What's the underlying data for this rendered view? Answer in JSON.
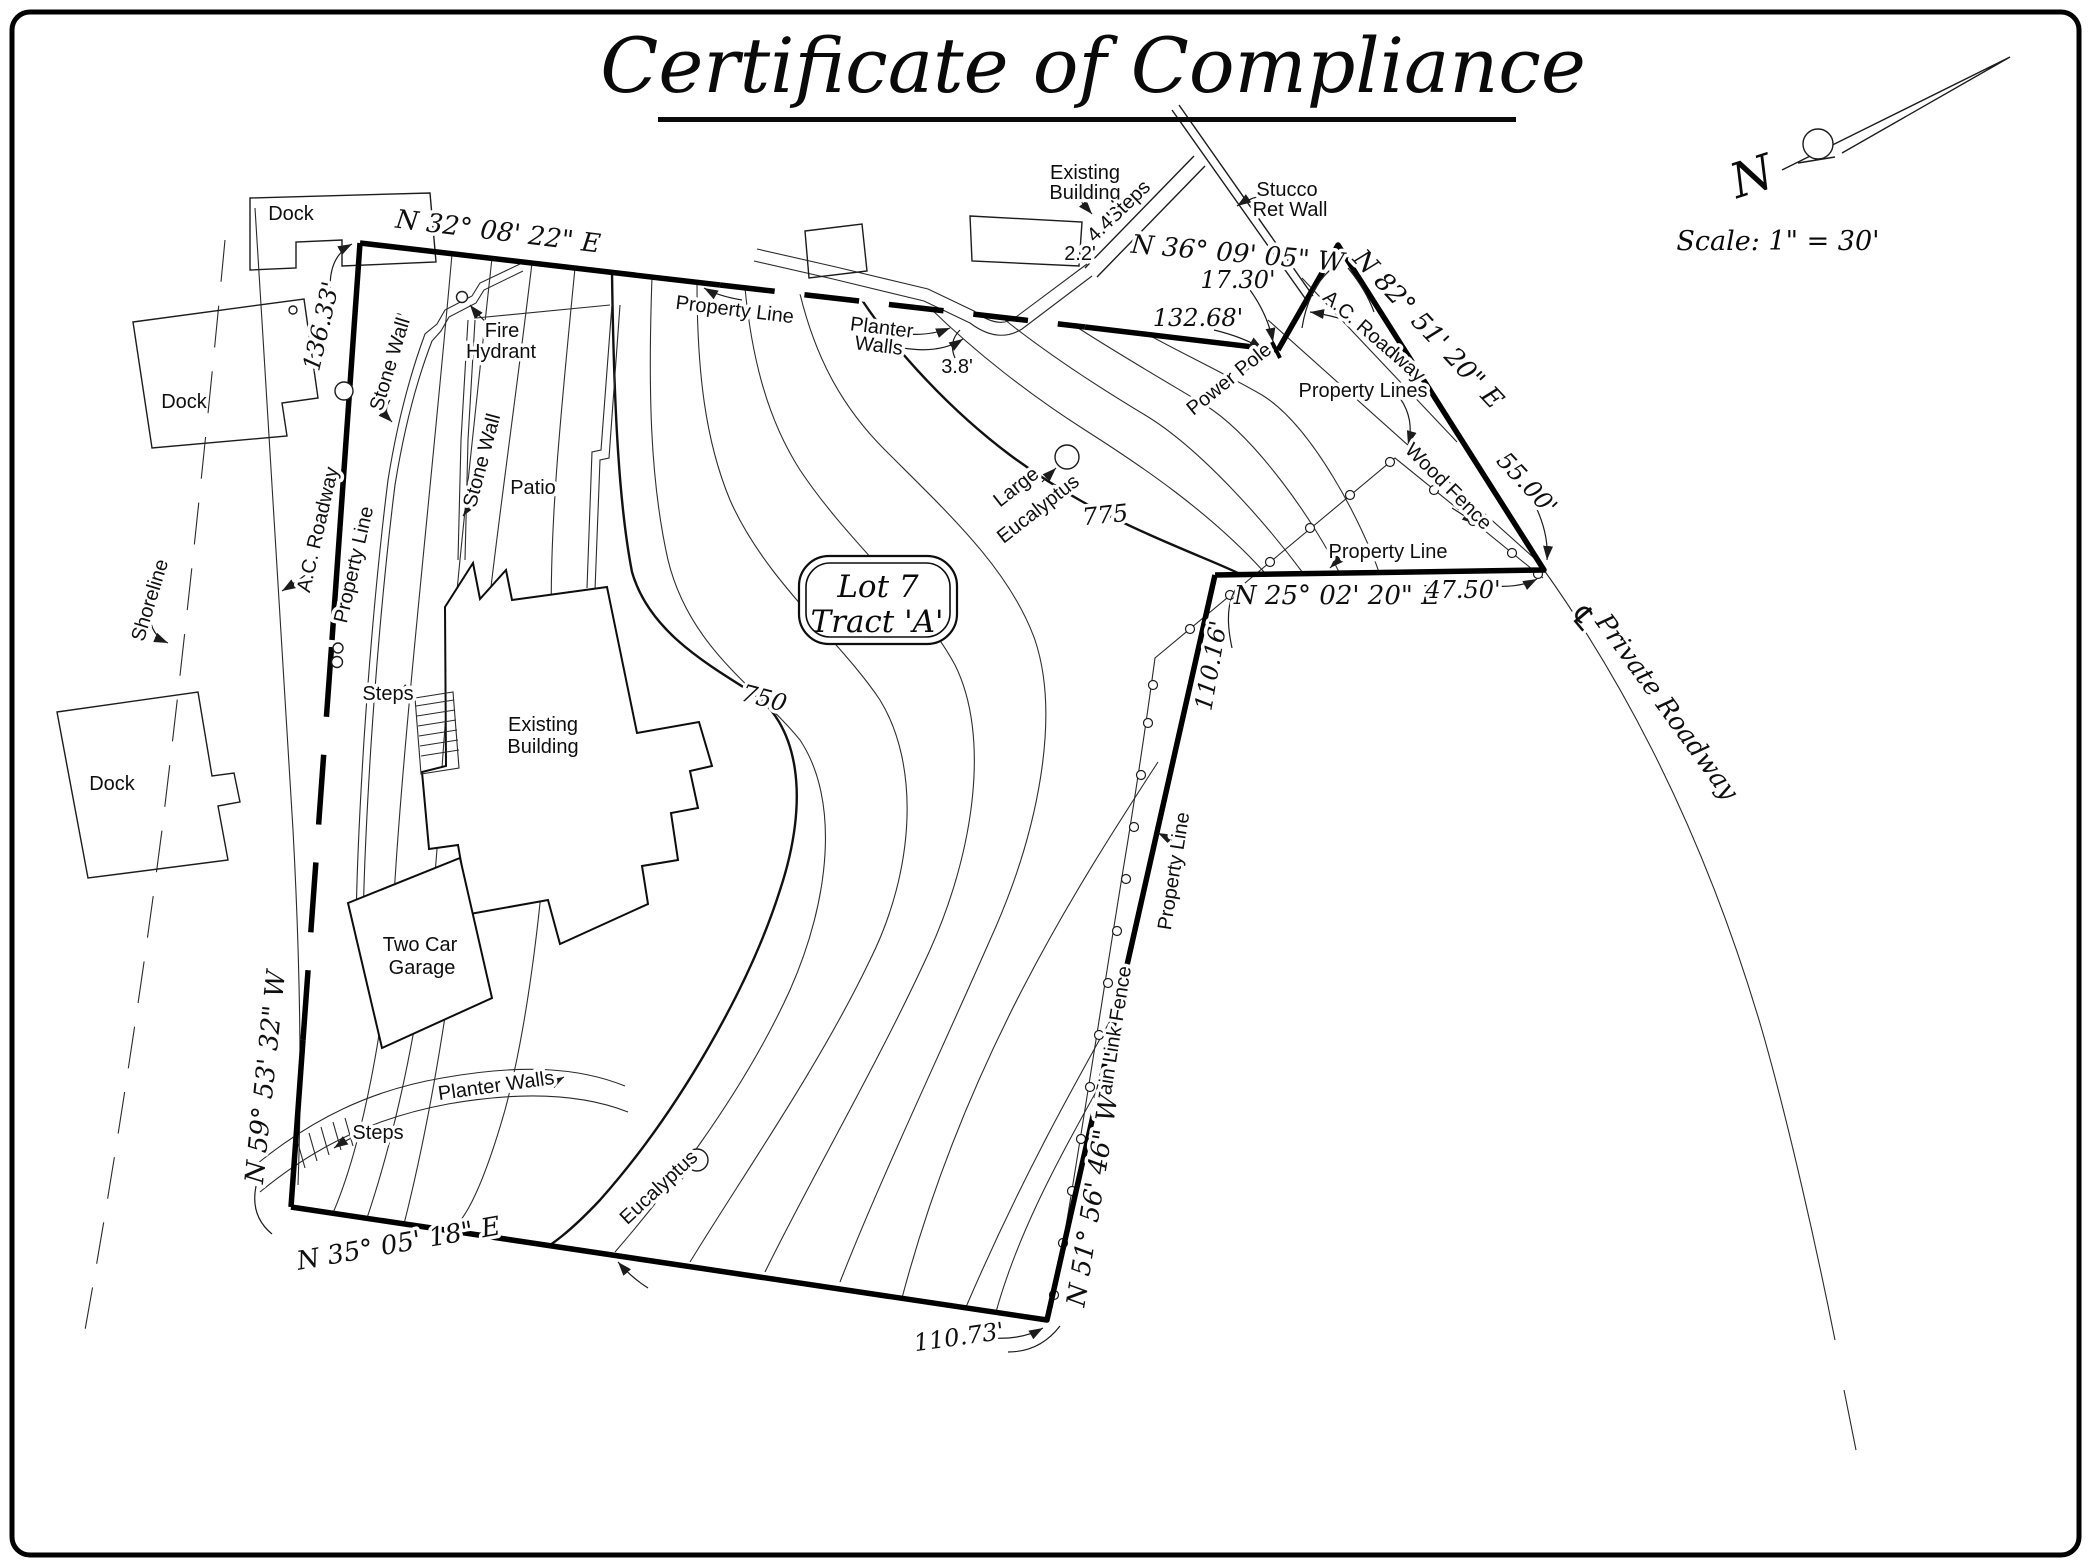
{
  "title": "Certificate of Compliance",
  "scale_label": "Scale: 1\" = 30'",
  "north": {
    "letter": "N"
  },
  "lot": {
    "line1": "Lot 7",
    "line2": "Tract 'A'"
  },
  "contour_labels": {
    "c750": "750",
    "c775": "775"
  },
  "bearings": {
    "n32": "N 32° 08' 22\" E",
    "n36": "N 36° 09' 05\" W",
    "n82": "N 82° 51' 20\" E",
    "n25": "N 25° 02' 20\" E",
    "n51": "N 51° 56' 46\" W",
    "n35": "N 35° 05' 18\" E",
    "n59": "N 59° 53' 32\" W"
  },
  "distances": {
    "d136_33": "136.33'",
    "d17_30": "17.30'",
    "d132_68": "132.68'",
    "d55_00": "55.00'",
    "d47_50": "47.50'",
    "d110_16": "110.16'",
    "d110_73": "110.73'",
    "d2_2": "2.2'",
    "d4_4": "4.4'",
    "d3_8": "3.8'"
  },
  "features": {
    "dock": "Dock",
    "shoreline": "Shoreline",
    "ac_roadway": "A.C. Roadway",
    "property_line": "Property Line",
    "property_lines": "Property Lines",
    "stone_wall": "Stone Wall",
    "patio": "Patio",
    "fire": "Fire",
    "hydrant": "Hydrant",
    "planter": "Planter",
    "walls": "Walls",
    "planter_walls": "Planter Walls",
    "existing": "Existing",
    "building": "Building",
    "steps": "Steps",
    "stucco": "Stucco",
    "ret_wall": "Ret Wall",
    "power_pole": "Power Pole",
    "wood_fence": "Wood Fence",
    "chain_link_fence": "Chain Link Fence",
    "private_roadway": "Private Roadway",
    "eucalyptus": "Eucalyptus",
    "large": "Large",
    "two_car": "Two Car",
    "garage": "Garage",
    "centerline": "℄"
  }
}
